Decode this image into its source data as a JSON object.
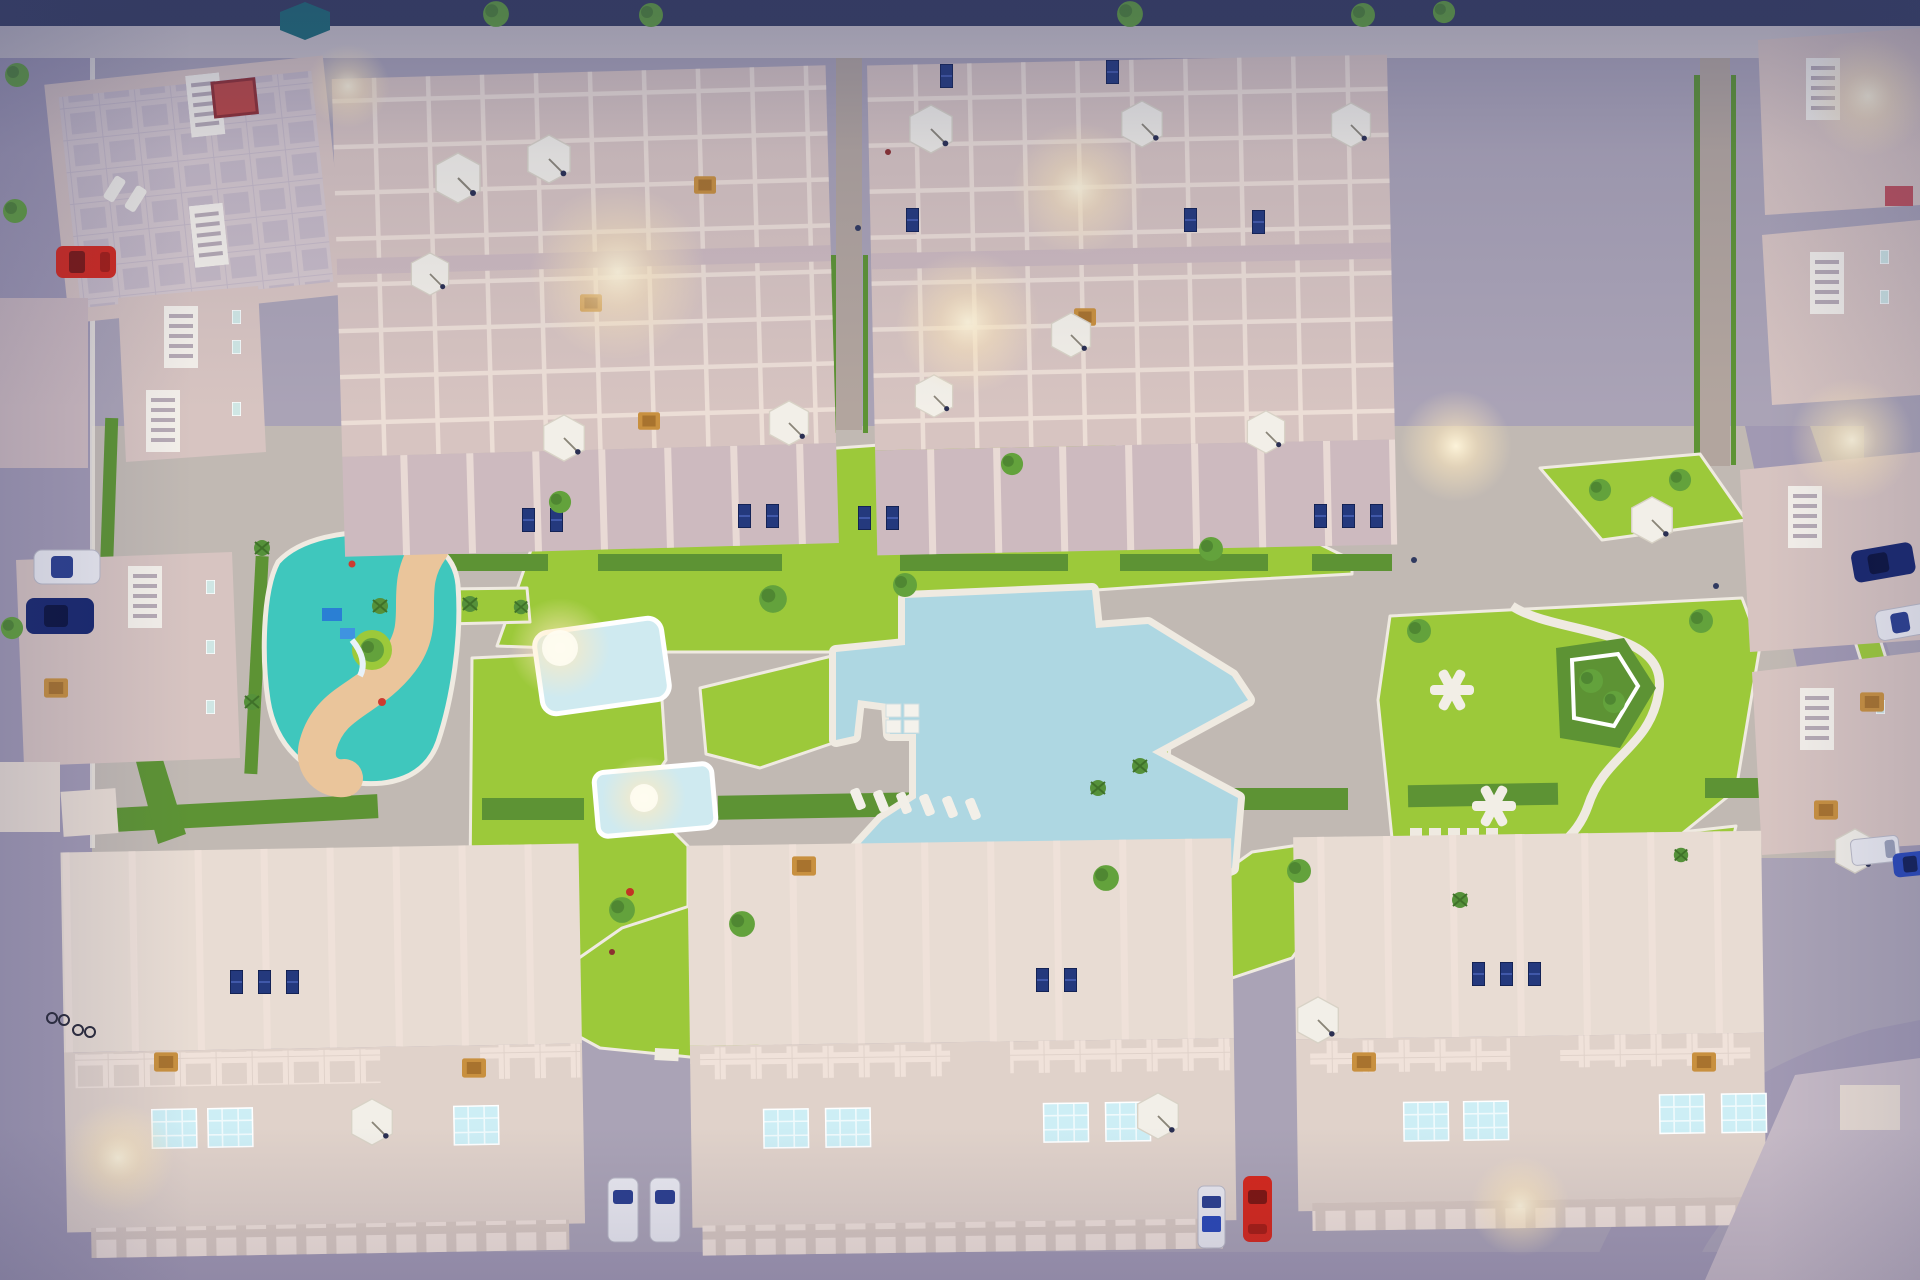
{
  "meta": {
    "title": "Aerial dusk render - residential complex with central pool",
    "type": "3D architectural visualization",
    "view": "top-down aerial",
    "time_of_day": "dusk"
  },
  "palette": {
    "street": "#aaa3b6",
    "street2": "#a199b3",
    "street_dark": "#363c5e",
    "sidewalk": "#ccc4c9",
    "court": "#c1b9b3",
    "alley": "#b2a59e",
    "bld_pink": "#d7c4c1",
    "bld_pink2": "#cdbabf",
    "bld_wall": "#f0e2da",
    "bld_roof": "#c6bac6",
    "bld_cream": "#e8dcd3",
    "bld_cream2": "#e0d2ca",
    "colonnade": "#d8c9c1",
    "lawn": "#9cc93a",
    "lawn_dark": "#85b52c",
    "hedge": "#5d9334",
    "hedge_dark": "#47792c",
    "tree": "#63a23c",
    "tree_dark": "#3f7129",
    "palm": "#55913a",
    "pool": "#aed7e2",
    "pool_light": "#cfeaf0",
    "poolsq": "#cdeef5",
    "playground_teal": "#3fc7bd",
    "playground_sand": "#eac59b",
    "umbrella": "#f2efe8",
    "umbrella_teal": "#1d6b75",
    "car_red": "#d6281c",
    "car_white": "#e9e9f0",
    "car_navy": "#18276e",
    "car_blue": "#2948b8",
    "panel": "#24397d",
    "tan": "#c8903f",
    "glow": "#ffedc2",
    "path_white": "#efeae1"
  },
  "scene": {
    "amenities": [
      "free-form main swimming pool with white deck",
      "lit children's pool",
      "lit small lap pool",
      "teal playground with winding sand path and play structures",
      "lawn park with white X picnic tables and pentagon hedge",
      "central paved promenade",
      "perimeter streets with parked cars"
    ],
    "buildings": [
      {
        "id": "corner-villa-top-left",
        "label": "corner villa with roof terrace, red rug and loungers"
      },
      {
        "id": "townhouse-block-west",
        "label": "townhouse block with roof terraces and parasols"
      },
      {
        "id": "townhouse-block-east",
        "label": "townhouse block with roof terraces and parasols"
      },
      {
        "id": "row-houses-left",
        "label": "row houses with white stair roofs"
      },
      {
        "id": "row-houses-right",
        "label": "row houses with white stair roofs"
      },
      {
        "id": "apartment-block-southwest",
        "label": "apartment block with rooftop plunge pools"
      },
      {
        "id": "apartment-block-south-center",
        "label": "apartment block with rooftop plunge pools"
      },
      {
        "id": "apartment-block-southeast",
        "label": "apartment block with rooftop plunge pools"
      },
      {
        "id": "corner-block-bottom-right",
        "label": "partially visible corner block"
      }
    ],
    "vehicles": [
      {
        "color": "red",
        "location": "left street"
      },
      {
        "color": "white",
        "location": "left street"
      },
      {
        "color": "dark blue",
        "location": "left street"
      },
      {
        "color": "dark blue",
        "location": "right street"
      },
      {
        "color": "white",
        "location": "right street"
      },
      {
        "color": "white van",
        "location": "bottom-right street"
      },
      {
        "color": "blue",
        "location": "bottom-right street"
      },
      {
        "color": "white",
        "location": "south alley west"
      },
      {
        "color": "white",
        "location": "south alley west"
      },
      {
        "color": "white-blue",
        "location": "south alley east"
      },
      {
        "color": "red",
        "location": "south alley east"
      }
    ],
    "counts": {
      "white_parasols": 16,
      "teal_parasols": 1,
      "rooftop_plunge_pools": 11,
      "solar_panel_groups": 22,
      "picnic_x_tables": 2,
      "in_pool_loungers": 4,
      "deck_loungers": 6,
      "bicycles": 2
    },
    "lighting": {
      "mood": "dusk, warm terrace lights glowing",
      "glow_spots": 11
    }
  }
}
